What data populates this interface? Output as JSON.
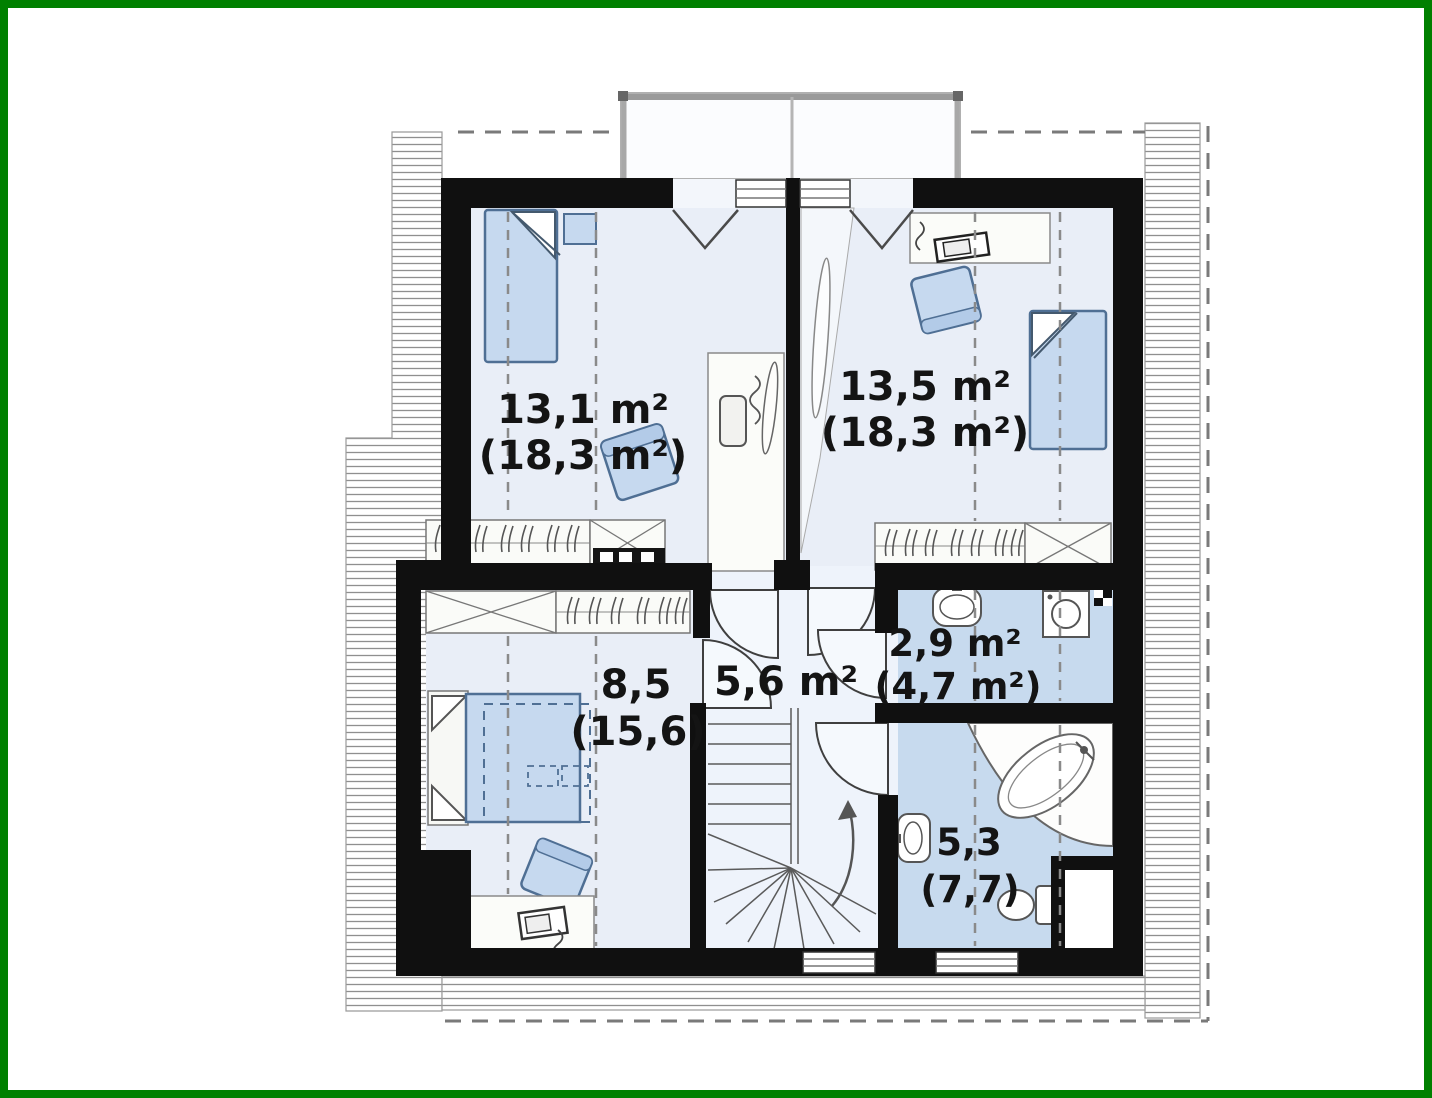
{
  "plan": {
    "type": "floor-plan-attic-storey",
    "rooms": [
      {
        "id": "bedroom-top-left",
        "area": "13,1 m²",
        "area_gross": "(18,3 m²)"
      },
      {
        "id": "bedroom-top-right",
        "area": "13,5 m²",
        "area_gross": "(18,3 m²)"
      },
      {
        "id": "bedroom-bottom-left",
        "area": "8,5",
        "area_gross": "(15,6)"
      },
      {
        "id": "hall",
        "area": "5,6 m²",
        "area_gross": ""
      },
      {
        "id": "bathroom-small",
        "area": "2,9 m²",
        "area_gross": "(4,7 m²)"
      },
      {
        "id": "bathroom-main",
        "area": "5,3",
        "area_gross": "(7,7)"
      }
    ],
    "icons": [
      "bed-icon",
      "double-bed-icon",
      "armchair-icon",
      "desk-icon",
      "wardrobe-hanging-icon",
      "wardrobe-cross-icon",
      "dresser-icon",
      "stairs-winder-icon",
      "up-arrow-icon",
      "door-swing-icon",
      "window-icon",
      "sink-icon",
      "washing-machine-icon",
      "corner-bathtub-icon",
      "toilet-icon",
      "dormer-icon",
      "roof-eaves-hatch-icon"
    ],
    "colors": {
      "frame_border": "#008000",
      "walls": "#101010",
      "room_fill": "#e9eef7",
      "hall_fill": "#eef3fb",
      "bathroom_fill": "#c7daee",
      "furniture_blue": "#c6d9ef",
      "hatch_line": "#8f8f8f",
      "dashed_line": "#8a8a8a",
      "label_text": "#141414"
    }
  }
}
